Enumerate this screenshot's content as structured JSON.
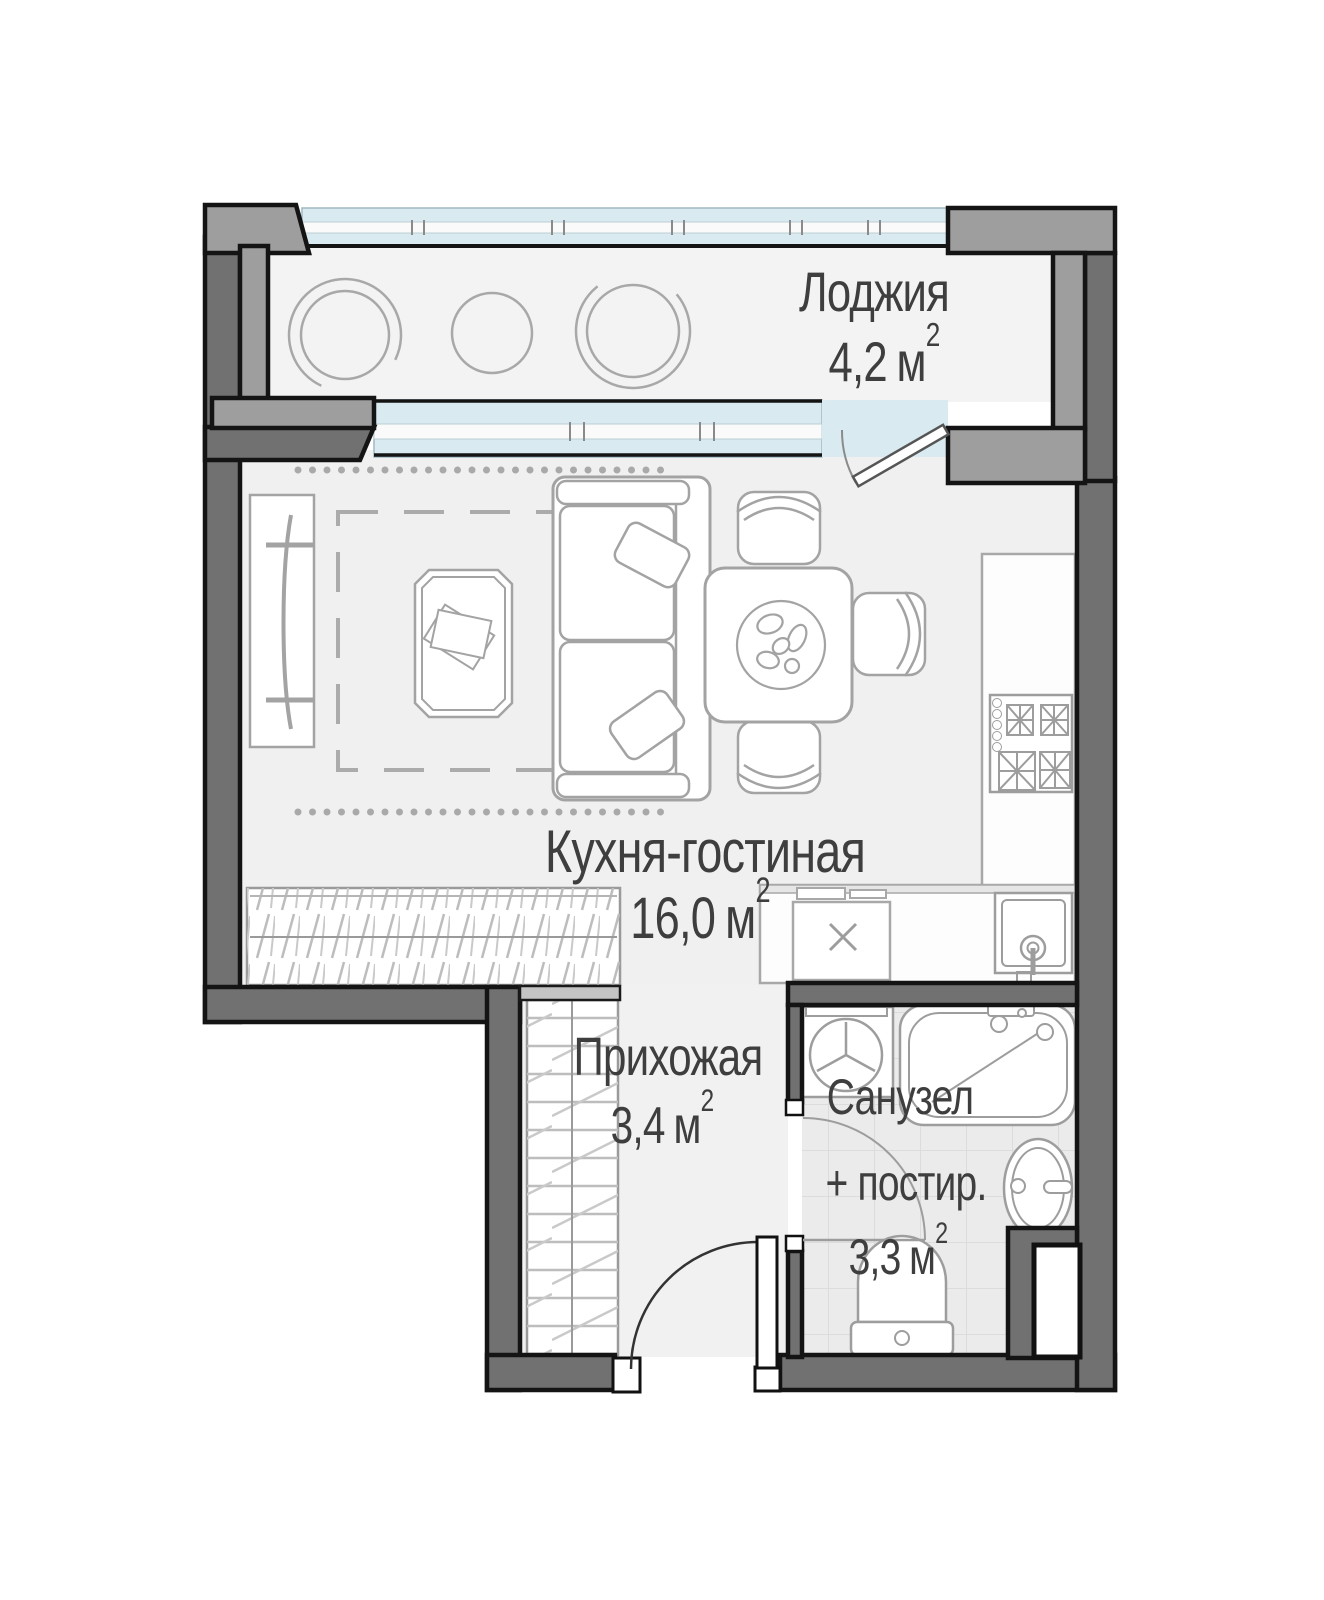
{
  "rooms": {
    "loggia": {
      "name": "Лоджия",
      "area": "4,2",
      "unit": "м",
      "sup": "2"
    },
    "kitchen_living": {
      "name": "Кухня-гостиная",
      "area": "16,0",
      "unit": "м",
      "sup": "2"
    },
    "hallway": {
      "name": "Прихожая",
      "area": "3,4",
      "unit": "м",
      "sup": "2"
    },
    "bathroom": {
      "name": "Санузел",
      "name_line2": "+ постир.",
      "area": "3,3",
      "unit": "м",
      "sup": "2"
    }
  },
  "colors": {
    "wall_dark": "#717171",
    "wall_light": "#9e9e9e",
    "wall_outline": "#141414",
    "glass": "#d9ebf1",
    "floor": "#f0f0f0",
    "tile_floor": "#ebebeb",
    "furniture_stroke": "#a3a3a3",
    "label_text": "#3e3e3e"
  }
}
